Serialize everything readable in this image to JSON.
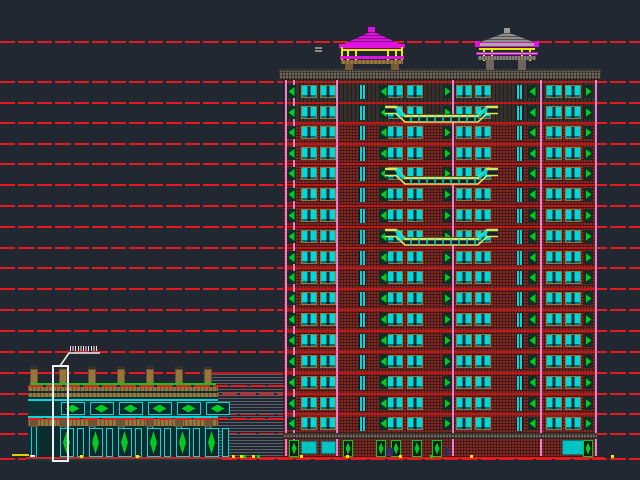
{
  "canvas": {
    "width": 640,
    "height": 480,
    "background": "#212831",
    "content": "architectural elevation drawing: high-rise residential tower with two rooftop pavilions, two-storey podium building, louver panel, floor datum lines and a white detail callout"
  },
  "colors": {
    "red": "#e81a20",
    "slab": "#bf1616",
    "brick": "#7b2b26",
    "darkwall": "#35302c",
    "cyan": "#00d9d9",
    "green": "#00cc22",
    "tan": "#96763f",
    "pink": "#ee7ed4",
    "magenta": "#e012e0",
    "yellow": "#e8e800",
    "balcony": "#d6e75c",
    "cornice": "#6e665a",
    "navy": "#25307a",
    "white": "#f0f0f0",
    "hatch": "#596069",
    "store": "#00c4c4"
  },
  "datum_lines": {
    "ys": [
      41,
      81,
      102,
      122,
      143,
      163,
      184,
      205,
      226,
      247,
      267,
      288,
      309,
      330,
      351,
      372,
      393,
      413,
      433,
      458
    ],
    "thickness": 2
  },
  "tower": {
    "x": 283,
    "w": 314,
    "top": 80,
    "bottom": 457,
    "cornice": {
      "x": 279,
      "y": 69,
      "w": 322,
      "h": 11
    },
    "lintel": {
      "y": 433,
      "h": 6
    },
    "dark_upper_h": 42,
    "floor_ys": [
      81,
      102,
      122,
      143,
      163,
      184,
      205,
      226,
      247,
      267,
      288,
      309,
      330,
      351,
      372,
      393,
      413,
      433
    ],
    "pink_xs": [
      284.5,
      293,
      336,
      452,
      540,
      594.5
    ],
    "window_units_rel": [
      18,
      37,
      104,
      124,
      173,
      192,
      263,
      282
    ],
    "slit_rel": [
      76,
      233
    ],
    "brackets_rel": [
      {
        "x": 4,
        "dir": "l"
      },
      {
        "x": 96,
        "dir": "l"
      },
      {
        "x": 160,
        "dir": "r"
      },
      {
        "x": 245,
        "dir": "l"
      },
      {
        "x": 301,
        "dir": "r"
      }
    ],
    "balconies": {
      "x": 384,
      "w": 115,
      "h": 19,
      "ys": [
        104,
        166,
        227
      ]
    },
    "storefronts": [
      [
        301,
        441,
        16,
        13
      ],
      [
        321,
        441,
        15,
        13
      ],
      [
        562,
        440,
        26,
        15
      ]
    ],
    "door_xs": [
      289,
      343,
      376,
      391,
      412,
      432,
      583
    ],
    "door": {
      "y": 440,
      "w": 10,
      "h": 17
    },
    "figures": [
      [
        386,
        447,
        3,
        9
      ],
      [
        390,
        448,
        3,
        8
      ],
      [
        446,
        447,
        3,
        9
      ]
    ]
  },
  "pavilions": {
    "left": {
      "roof": [
        342,
        31,
        60,
        14
      ],
      "finial": [
        368,
        27,
        7,
        5
      ],
      "eave": [
        339,
        44,
        66,
        5
      ],
      "trim": [
        341,
        49,
        62,
        2
      ],
      "columns": [
        [
          347,
          50
        ],
        [
          355,
          50
        ],
        [
          387,
          50
        ],
        [
          395,
          50
        ],
        [
          341,
          47
        ],
        [
          401,
          47
        ]
      ],
      "col_h": 13,
      "beam": [
        340,
        56,
        64,
        3
      ],
      "platform": [
        341,
        60,
        62,
        4
      ],
      "legs": [
        [
          345,
          64
        ],
        [
          391,
          64
        ]
      ],
      "leg_h": 6
    },
    "right": {
      "roof": [
        478,
        32,
        58,
        11
      ],
      "finial": [
        504,
        28,
        6,
        5
      ],
      "eave": [
        475,
        42,
        64,
        5
      ],
      "tips": [
        [
          475,
          41
        ],
        [
          534,
          41
        ]
      ],
      "trim": [
        479,
        48,
        56,
        2
      ],
      "columns": [
        [
          483,
          49
        ],
        [
          491,
          49
        ],
        [
          521,
          49
        ],
        [
          529,
          49
        ]
      ],
      "col_h": 12,
      "beam": [
        476,
        52,
        62,
        3
      ],
      "platform": [
        478,
        56,
        58,
        4
      ],
      "legs": [
        [
          486,
          60
        ],
        [
          518,
          60
        ]
      ],
      "leg_h": 10
    },
    "equals_mark": [
      315,
      47,
      7,
      2
    ]
  },
  "louver_panel": {
    "x": 212,
    "y": 374,
    "w": 75,
    "h": 84
  },
  "podium": {
    "x": 28,
    "w": 190,
    "cap_xs": [
      30,
      59,
      88,
      117,
      146,
      175,
      204
    ],
    "cap": {
      "y": 366,
      "w": 8,
      "h": 18
    },
    "green_line": [
      30,
      383,
      186,
      2
    ],
    "tan_band_ys": [
      387,
      393
    ],
    "band_h": 4,
    "cyan_line_ys": [
      399,
      416
    ],
    "upper_bg": [
      28,
      386,
      190,
      15
    ],
    "window_row": {
      "bg": [
        28,
        401,
        190,
        15
      ],
      "win_y": 402,
      "win_h": 13,
      "win_w": 24
    },
    "bay_centers": [
      44.5,
      73.5,
      102.5,
      131.5,
      160.5,
      189.5
    ],
    "sill": [
      28,
      419,
      190,
      7
    ],
    "post": {
      "y": 418,
      "w": 8,
      "h": 10
    },
    "lower_bg": [
      28,
      427,
      190,
      31
    ],
    "pilaster": {
      "y": 427,
      "w": 6,
      "h": 31
    },
    "vesica_panel": {
      "y": 428,
      "w": 14,
      "h": 29
    },
    "strip": {
      "y": 428,
      "w": 7,
      "h": 29
    },
    "base": [
      26,
      458,
      194,
      3
    ],
    "level_line_ys": [
      385,
      418
    ],
    "level_line_x2": 287
  },
  "callout": {
    "box": [
      52,
      365,
      17,
      97
    ],
    "leader_points": "10,23 19,10 50,10",
    "leader_pos": [
      50,
      343,
      60,
      26
    ],
    "ticks": [
      70,
      346,
      28,
      5
    ]
  },
  "ground_marks": {
    "solid_line": [
      26,
      457,
      578,
      2
    ],
    "yellow_dash": [
      12,
      454,
      17,
      2
    ],
    "white_dash": [
      30,
      455,
      5,
      2
    ],
    "yellow_dot_xs": [
      80,
      136,
      232,
      240,
      252,
      300,
      346,
      399,
      470,
      611
    ],
    "green_dot_xs": [
      243,
      257,
      430
    ],
    "dot_y": 455,
    "dot_size": 3
  }
}
